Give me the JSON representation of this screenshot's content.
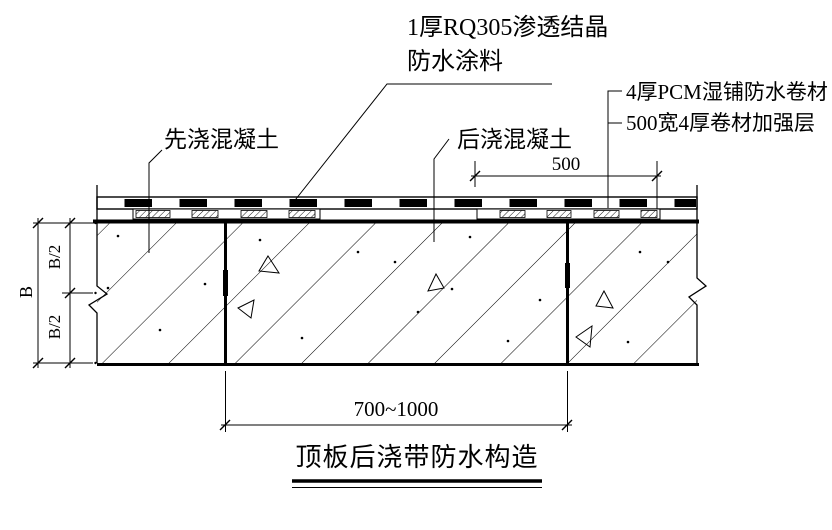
{
  "title": {
    "text": "顶板后浇带防水构造"
  },
  "callouts": {
    "coating": {
      "line1": "1厚RQ305渗透结晶",
      "line2": "防水涂料"
    },
    "membrane": "4厚PCM湿铺防水卷材",
    "reinforcement": "500宽4厚卷材加强层",
    "first_pour_concrete": "先浇混凝土",
    "post_pour_concrete": "后浇混凝土"
  },
  "dimensions": {
    "reinforcement_width": "500",
    "post_pour_band_width": "700~1000",
    "slab_thickness": "B",
    "upper_half": "B/2",
    "lower_half": "B/2"
  },
  "colors": {
    "line": "#000000",
    "background": "#ffffff"
  }
}
